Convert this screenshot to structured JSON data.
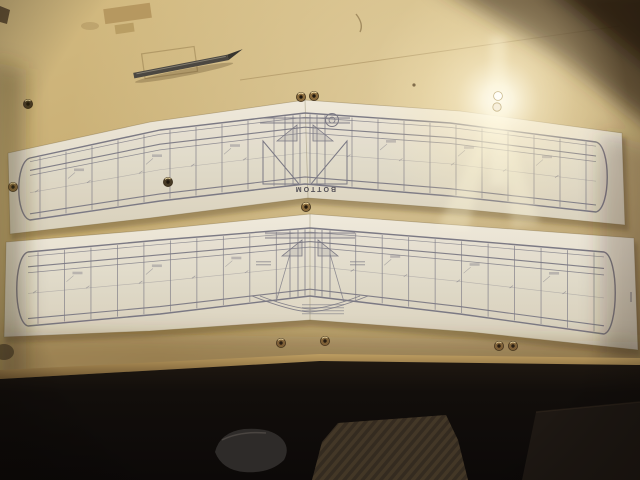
{
  "plan_sheets": {
    "top": {
      "printed_label": "BOTTOM"
    },
    "bottom": {
      "printed_label": ""
    }
  },
  "objects": {
    "knife": "hobby-knife",
    "pins": "push-pins",
    "pin_count": 12,
    "board": "building-board",
    "sheets": 2,
    "floor_items": [
      "carpet-patch",
      "shoe",
      "dark-object"
    ]
  },
  "colors": {
    "board": "#c6ac72",
    "board_shadow": "#5e4728",
    "paper": "#ece6d7",
    "plan_line": "#7b7984",
    "pin_brass": "#8a6b3c",
    "pin_dark": "#473a25",
    "glare": "#fff9e9",
    "floor": "#14100c",
    "carpet": "#55462f",
    "knife": "#4e4a43"
  }
}
